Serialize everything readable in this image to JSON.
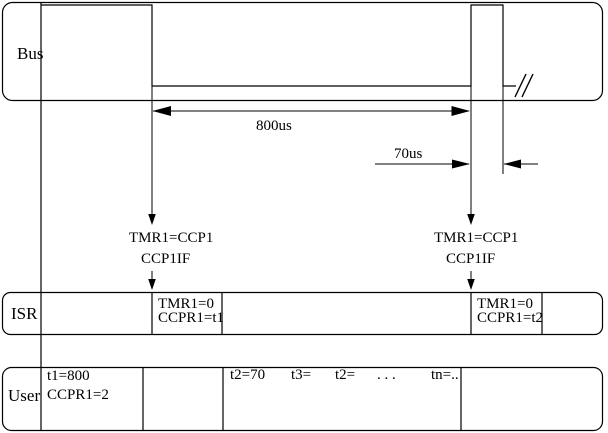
{
  "bus_band": {
    "label": "Bus"
  },
  "isr_band": {
    "label": "ISR",
    "cells": [
      {
        "line1": "TMR1=0",
        "line2": "CCPR1=t1"
      },
      {
        "line1": "TMR1=0",
        "line2": "CCPR1=t2"
      }
    ]
  },
  "user_band": {
    "label": "User",
    "cell1": {
      "line1": "t1=800",
      "line2": "CCPR1=2"
    },
    "cell2_tokens": [
      "t2=70",
      "t3=",
      "t2=",
      ". . .",
      "tn=.."
    ]
  },
  "annotations": {
    "dim_800us": "800us",
    "dim_70us": "70us",
    "event_left": {
      "line1": "TMR1=CCP1",
      "line2": "CCP1IF"
    },
    "event_right": {
      "line1": "TMR1=CCP1",
      "line2": "CCP1IF"
    }
  },
  "colors": {
    "line": "#000000",
    "background": "#ffffff"
  }
}
